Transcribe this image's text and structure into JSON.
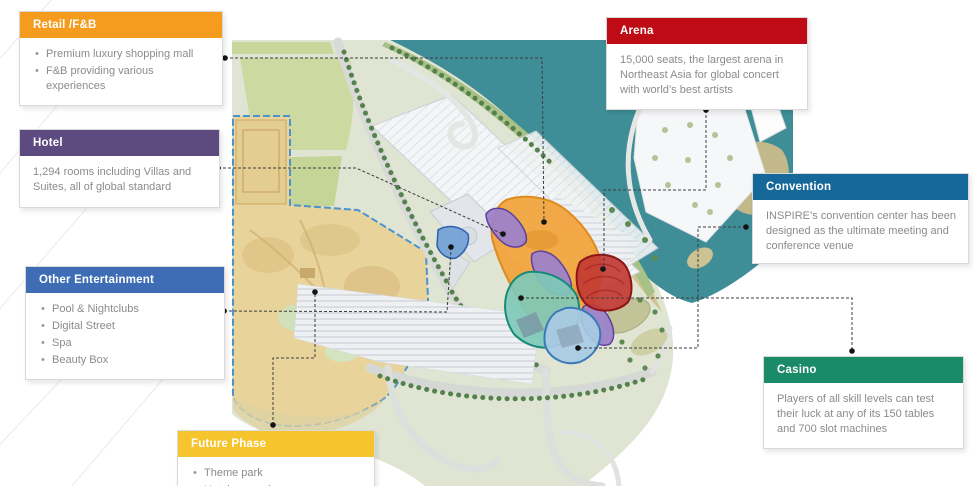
{
  "callouts": {
    "retail": {
      "title": "Retail /F&B",
      "header_color": "#F59C1F",
      "items": [
        "Premium luxury shopping mall",
        "F&B providing various experiences"
      ]
    },
    "hotel": {
      "title": "Hotel",
      "header_color": "#5D4B80",
      "body": "1,294 rooms including Villas and Suites, all of global standard"
    },
    "other": {
      "title": "Other Entertainment",
      "header_color": "#3E6DB5",
      "items": [
        "Pool & Nightclubs",
        "Digital Street",
        "Spa",
        "Beauty Box"
      ]
    },
    "arena": {
      "title": "Arena",
      "header_color": "#BF0B15",
      "body": "15,000 seats, the largest arena in Northeast Asia for global concert with world’s best artists"
    },
    "convention": {
      "title": "Convention",
      "header_color": "#17689A",
      "body": "INSPIRE’s convention center has been designed as the ultimate meeting and conference venue"
    },
    "casino": {
      "title": "Casino",
      "header_color": "#1B8A67",
      "body": "Players of all skill levels can test their luck at any of its 150 tables and 700 slot machines"
    },
    "future": {
      "title": "Future Phase",
      "header_color": "#F6C52E",
      "items": [
        "Theme park",
        "Hotel expansion"
      ]
    }
  },
  "map": {
    "water_color": "#3F8E97",
    "regions": [
      {
        "id": "retail-fnb-area",
        "color": "#F2A237",
        "border": "#DE8B1E"
      },
      {
        "id": "hotel-towers",
        "color": "#9C82C8",
        "border": "#5F3F9E"
      },
      {
        "id": "arena-area",
        "color": "#C23B33",
        "border": "#8F1418"
      },
      {
        "id": "casino-area",
        "color": "#7FC9B8",
        "border": "#178A7B"
      },
      {
        "id": "convention-area",
        "color": "#A8CBE4",
        "border": "#3A7AB8"
      },
      {
        "id": "pool-entertainment",
        "color": "#6F9ED6",
        "border": "#2F5FAE"
      },
      {
        "id": "future-phase-area",
        "color": "#E8D49A",
        "border": "#4B93CF"
      }
    ]
  }
}
